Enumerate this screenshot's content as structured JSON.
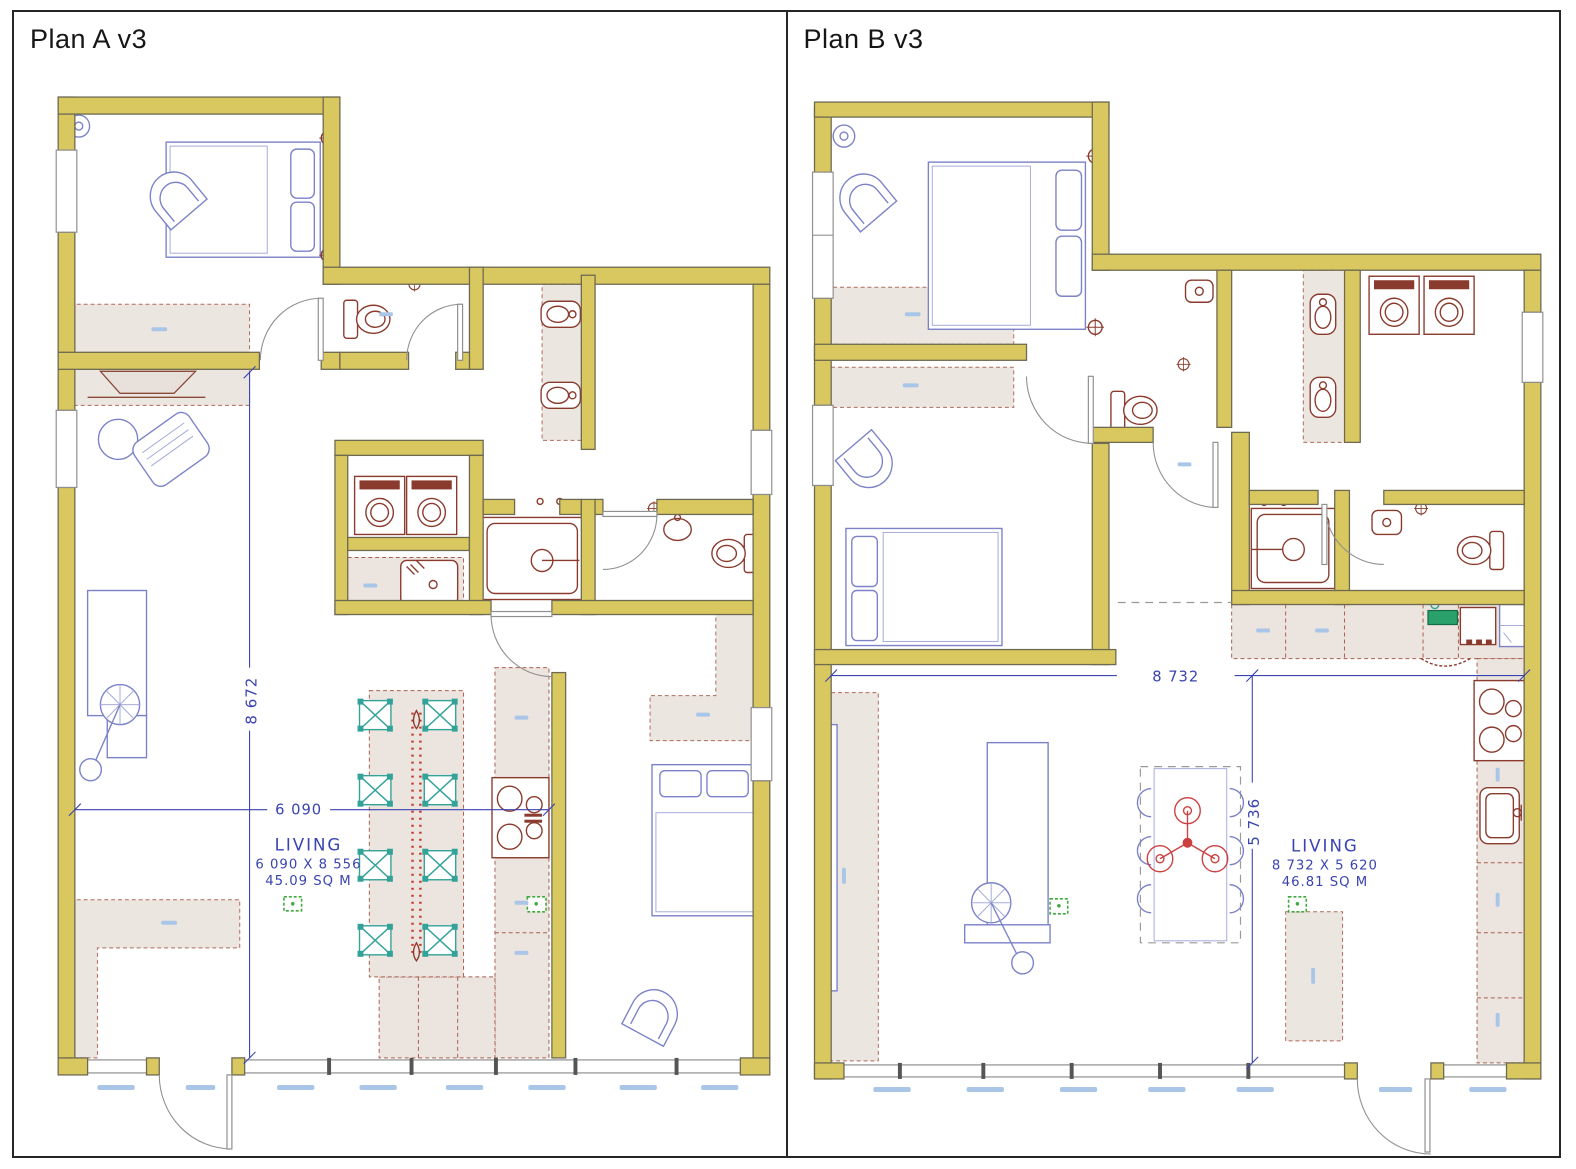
{
  "page": {
    "background": "#ffffff",
    "border_color": "#262626"
  },
  "panels": [
    {
      "id": "plan-a",
      "title": "Plan A v3",
      "dimension_labels": {
        "width": "6 090",
        "height": "8 672"
      },
      "living_label": {
        "room": "LIVING",
        "dimensions": "6 090 X 8 556",
        "area": "45.09 SQ M"
      }
    },
    {
      "id": "plan-b",
      "title": "Plan B v3",
      "dimension_labels": {
        "width": "8 732",
        "height": "5 736"
      },
      "living_label": {
        "room": "LIVING",
        "dimensions": "8 732 X 5 620",
        "area": "46.81 SQ M"
      }
    }
  ],
  "colors": {
    "wall": "#d9c75f",
    "wall_outline": "#6e6a52",
    "rug_fill": "#ece6e1",
    "rug_border": "#b06a5a",
    "furniture_blue": "#7b82c8",
    "fixture_red": "#8a3b2d",
    "chair_teal": "#33a39a",
    "sensor_green": "#3faa3f",
    "cutting_board_green": "#2aa06a",
    "dimension_blue": "#3a44b0",
    "annotation_blue": "#a9c6e8",
    "window_gray": "#8f8f8f",
    "fan_red": "#cc4040"
  }
}
